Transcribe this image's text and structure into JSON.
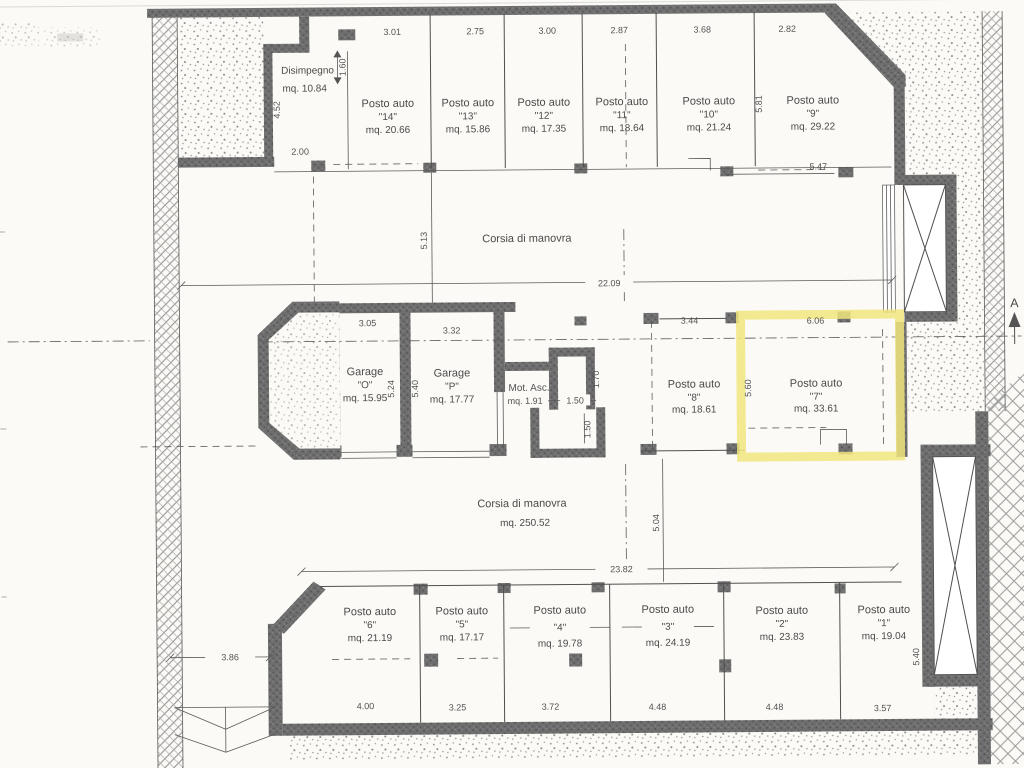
{
  "plan": {
    "section_marker": "A",
    "disimpegno": {
      "name": "Disimpegno",
      "area": "mq. 10.84"
    },
    "corsia_upper": {
      "name": "Corsia di manovra"
    },
    "corsia_lower": {
      "name": "Corsia di manovra",
      "area": "mq. 250.52"
    },
    "mot_asc": {
      "name": "Mot. Asc.",
      "area": "mq. 1.91"
    },
    "garages": [
      {
        "name": "Garage",
        "number": "\"O\"",
        "area": "mq. 15.95",
        "width_dim": "3.05",
        "depth_dim": "5.24"
      },
      {
        "name": "Garage",
        "number": "\"P\"",
        "area": "mq. 17.77",
        "width_dim": "3.32",
        "depth_dim": "5.40"
      }
    ],
    "top_row": [
      {
        "name": "Posto auto",
        "number": "\"14\"",
        "area": "mq. 20.66",
        "width_dim": "3.01"
      },
      {
        "name": "Posto auto",
        "number": "\"13\"",
        "area": "mq. 15.86",
        "width_dim": "2.75"
      },
      {
        "name": "Posto auto",
        "number": "\"12\"",
        "area": "mq. 17.35",
        "width_dim": "3.00"
      },
      {
        "name": "Posto auto",
        "number": "\"11\"",
        "area": "mq. 18.64",
        "width_dim": "2.87"
      },
      {
        "name": "Posto auto",
        "number": "\"10\"",
        "area": "mq. 21.24",
        "width_dim": "3.68"
      },
      {
        "name": "Posto auto",
        "number": "\"9\"",
        "area": "mq. 29.22",
        "width_dim": "2.82",
        "depth_dim": "5.81"
      }
    ],
    "middle_row": [
      {
        "name": "Posto auto",
        "number": "\"8\"",
        "area": "mq. 18.61",
        "width_dim": "3.44"
      },
      {
        "name": "Posto auto",
        "number": "\"7\"",
        "area": "mq. 33.61",
        "width_dim": "6.06",
        "depth_dim": "5.60",
        "highlighted": true
      }
    ],
    "bottom_row": [
      {
        "name": "Posto auto",
        "number": "\"6\"",
        "area": "mq. 21.19",
        "width_dim": "4.00"
      },
      {
        "name": "Posto auto",
        "number": "\"5\"",
        "area": "mq. 17.17",
        "width_dim": "3.25"
      },
      {
        "name": "Posto auto",
        "number": "\"4\"",
        "area": "mq. 19.78",
        "width_dim": "3.72"
      },
      {
        "name": "Posto auto",
        "number": "\"3\"",
        "area": "mq. 24.19",
        "width_dim": "4.48"
      },
      {
        "name": "Posto auto",
        "number": "\"2\"",
        "area": "mq. 23.83",
        "width_dim": "4.48"
      },
      {
        "name": "Posto auto",
        "number": "\"1\"",
        "area": "mq. 19.04",
        "width_dim": "3.57",
        "depth_dim": "5.40"
      }
    ],
    "dims": {
      "disimpegno_door": "1.60",
      "disimpegno_height": "4.52",
      "disimpegno_width": "2.00",
      "corsia_upper_depth": "5.13",
      "corsia_upper_width": "22.09",
      "right_top_offset": "5.47",
      "motasc_room_h": "1.70",
      "motasc_room_w": "1.50",
      "motasc_room_v": "1.50",
      "corsia_lower_depth": "5.04",
      "corsia_lower_width": "23.82",
      "ramp_width": "3.86"
    },
    "colors": {
      "highlight": "#f1e57e",
      "wall": "#6e6e6e",
      "paper": "#fbfaf6"
    }
  }
}
